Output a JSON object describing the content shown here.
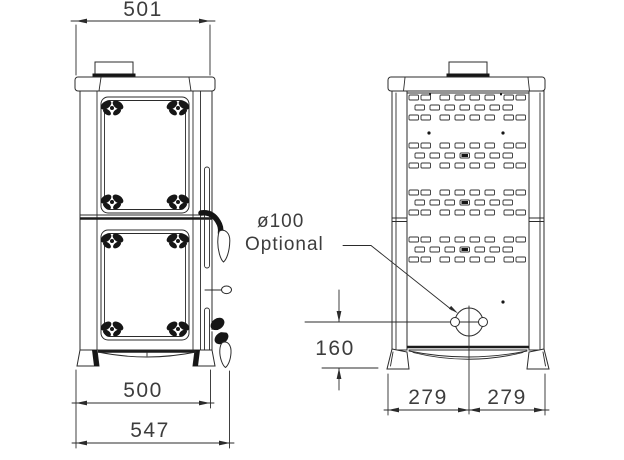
{
  "colors": {
    "background": "#ffffff",
    "line": "#2b2b2b",
    "text": "#3d3d3d"
  },
  "front_view": {
    "dim_top_width": "501",
    "dim_base_width": "500",
    "dim_overall_width": "547"
  },
  "rear_view": {
    "dim_hole_height": "160",
    "dim_left_half_width": "279",
    "dim_right_half_width": "279",
    "flue_annotation": {
      "diameter": "ø100",
      "note": "Optional"
    }
  }
}
